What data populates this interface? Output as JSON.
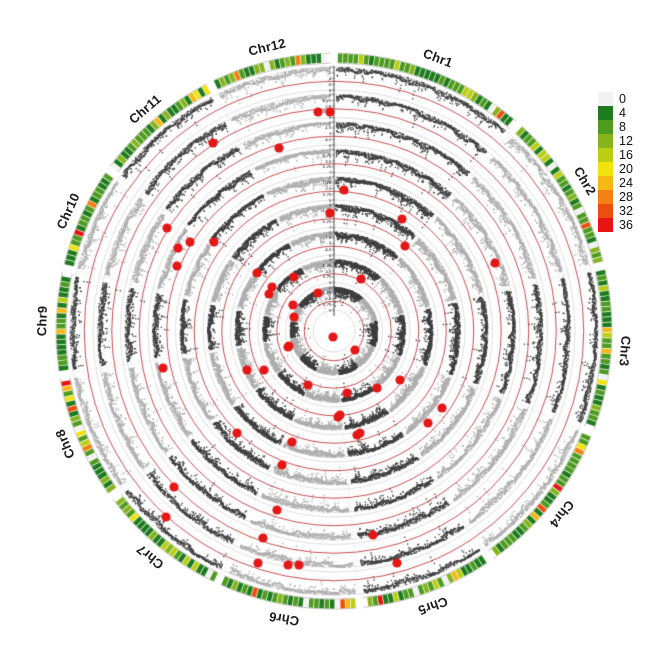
{
  "figure": {
    "width": 669,
    "height": 659,
    "background": "#ffffff"
  },
  "chart_data": {
    "type": "circular-manhattan",
    "chromosomes": [
      {
        "name": "Chr1",
        "fraction": 0.1161
      },
      {
        "name": "Chr2",
        "fraction": 0.0962
      },
      {
        "name": "Chr3",
        "fraction": 0.0976
      },
      {
        "name": "Chr4",
        "fraction": 0.0952
      },
      {
        "name": "Chr5",
        "fraction": 0.0802
      },
      {
        "name": "Chr6",
        "fraction": 0.0837
      },
      {
        "name": "Chr7",
        "fraction": 0.0796
      },
      {
        "name": "Chr8",
        "fraction": 0.0762
      },
      {
        "name": "Chr9",
        "fraction": 0.0617
      },
      {
        "name": "Chr10",
        "fraction": 0.0622
      },
      {
        "name": "Chr11",
        "fraction": 0.0778
      },
      {
        "name": "Chr12",
        "fraction": 0.0737
      }
    ],
    "tracks": [
      {
        "ticks": [
          "0",
          "2",
          "4",
          "6",
          "8"
        ],
        "max": 8
      },
      {
        "ticks": [
          "0",
          "1.25",
          "2.5",
          "3.75",
          "5"
        ],
        "max": 5
      },
      {
        "ticks": [
          "0",
          "1.5",
          "3",
          "4.5",
          "6"
        ],
        "max": 6
      },
      {
        "ticks": [
          "0",
          "1.75",
          "3.5",
          "5.25",
          "7"
        ],
        "max": 7
      },
      {
        "ticks": [
          "0",
          "1.25",
          "2.5",
          "3.75",
          "5"
        ],
        "max": 5
      },
      {
        "ticks": [
          "0",
          "1.75",
          "3.5",
          "5.25",
          "7"
        ],
        "max": 7
      },
      {
        "ticks": [
          "0",
          "1.5",
          "3",
          "4.5",
          "6"
        ],
        "max": 6
      },
      {
        "ticks": [
          "0",
          "1.25",
          "2.5",
          "3.75",
          "5"
        ],
        "max": 5
      },
      {
        "ticks": [
          "0",
          "1.25",
          "2.5",
          "3.75",
          "5"
        ],
        "max": 5
      }
    ],
    "legend": {
      "values": [
        "0",
        "4",
        "8",
        "12",
        "16",
        "20",
        "24",
        "28",
        "32",
        "36"
      ],
      "colors": [
        "#f2f2f2",
        "#1e7b1e",
        "#4d9b1f",
        "#86b41c",
        "#bcce14",
        "#f2e30c",
        "#f5b913",
        "#f18110",
        "#ec4f0d",
        "#e81313"
      ]
    },
    "significant_points": [
      [
        318,
        112
      ],
      [
        330,
        112
      ],
      [
        213,
        143
      ],
      [
        279,
        148
      ],
      [
        344,
        190
      ],
      [
        330,
        213
      ],
      [
        402,
        219
      ],
      [
        405,
        246
      ],
      [
        361,
        279
      ],
      [
        495,
        263
      ],
      [
        167,
        228
      ],
      [
        190,
        242
      ],
      [
        178,
        248
      ],
      [
        214,
        242
      ],
      [
        177,
        266
      ],
      [
        257,
        273
      ],
      [
        272,
        287
      ],
      [
        269,
        294
      ],
      [
        294,
        277
      ],
      [
        293,
        305
      ],
      [
        294,
        317
      ],
      [
        318,
        293
      ],
      [
        289,
        346
      ],
      [
        333,
        337
      ],
      [
        355,
        350
      ],
      [
        163,
        368
      ],
      [
        247,
        370
      ],
      [
        264,
        370
      ],
      [
        288,
        347
      ],
      [
        237,
        433
      ],
      [
        308,
        385
      ],
      [
        347,
        393
      ],
      [
        338,
        417
      ],
      [
        357,
        435
      ],
      [
        292,
        442
      ],
      [
        282,
        465
      ],
      [
        174,
        487
      ],
      [
        166,
        517
      ],
      [
        277,
        510
      ],
      [
        263,
        538
      ],
      [
        258,
        563
      ],
      [
        288,
        565
      ],
      [
        299,
        565
      ],
      [
        373,
        535
      ],
      [
        397,
        563
      ],
      [
        400,
        380
      ],
      [
        428,
        423
      ],
      [
        442,
        408
      ],
      [
        360,
        433
      ],
      [
        340,
        415
      ],
      [
        377,
        388
      ]
    ],
    "colors": {
      "point_dark": "#3f3f3f",
      "point_light": "#aeaeae",
      "threshold_line": "#b52025",
      "significant_point": "#e51616",
      "grid_line": "#dcdcdc",
      "track_edge": "#c3c3c3",
      "axis_line": "#3a3a3a",
      "chromosome_label": "#1a1a1a"
    },
    "layout": {
      "center_x": 334,
      "center_y": 331,
      "track_outer_radius": 264,
      "track_pitch": 27.5,
      "track_depth": 23,
      "threshold_fraction": 0.62,
      "ideogram_inner_radius": 268,
      "ideogram_outer_radius": 278,
      "label_radius": 292,
      "chr_gap_deg": 1.6,
      "axis_deg": 0,
      "center_hole_radius": 13,
      "legend_left": 598,
      "legend_top": 92
    },
    "density_ring": {
      "segment_deg": 0.95,
      "segment_gap_deg": 0.15,
      "seed": 11,
      "weights": [
        6,
        34,
        28,
        12,
        7,
        4.5,
        3,
        2.2,
        1.8,
        1.5
      ]
    },
    "scatter": {
      "seed": 42,
      "column_step_deg": 0.35
    }
  }
}
